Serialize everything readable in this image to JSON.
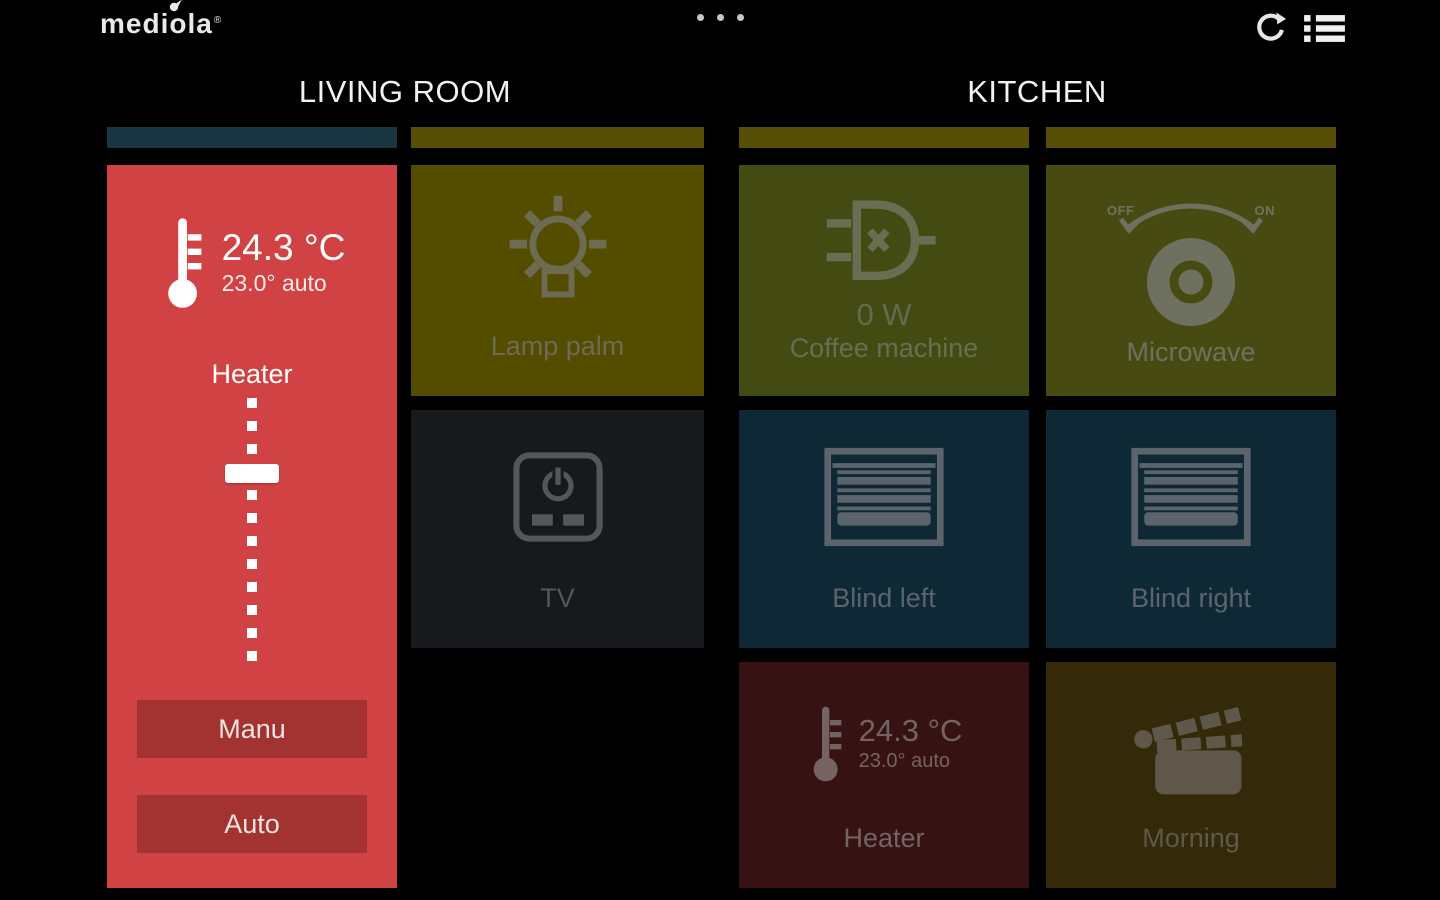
{
  "topbar": {
    "logo_text": "mediola",
    "trademark": "®",
    "page_indicator_dots": 3
  },
  "living_room": {
    "title": "LIVING ROOM",
    "heater_panel": {
      "temperature": "24.3 °C",
      "setpoint": "23.0° auto",
      "label": "Heater",
      "manu_button": "Manu",
      "auto_button": "Auto"
    },
    "lamp_tile": {
      "label": "Lamp palm"
    },
    "tv_tile": {
      "label": "TV"
    }
  },
  "kitchen": {
    "title": "KITCHEN",
    "coffee_tile": {
      "power": "0 W",
      "label": "Coffee machine"
    },
    "microwave_tile": {
      "label": "Microwave",
      "dial_off": "OFF",
      "dial_on": "ON"
    },
    "blind_left_tile": {
      "label": "Blind left"
    },
    "blind_right_tile": {
      "label": "Blind right"
    },
    "heater_tile": {
      "temperature": "24.3 °C",
      "setpoint": "23.0° auto",
      "label": "Heater"
    },
    "morning_tile": {
      "label": "Morning"
    }
  },
  "colors": {
    "background": "#000000",
    "heater_active_red": "#d04244",
    "heater_button_red": "#a33331",
    "tile_yellow": "#544d00",
    "tile_olive_green": "#434a12",
    "tile_dark_gray": "#17191c",
    "tile_navy": "#0e2836",
    "tile_maroon": "#361213",
    "tile_brown": "#342a09",
    "strip_teal": "#1a3542",
    "strip_olive": "#564e06"
  }
}
